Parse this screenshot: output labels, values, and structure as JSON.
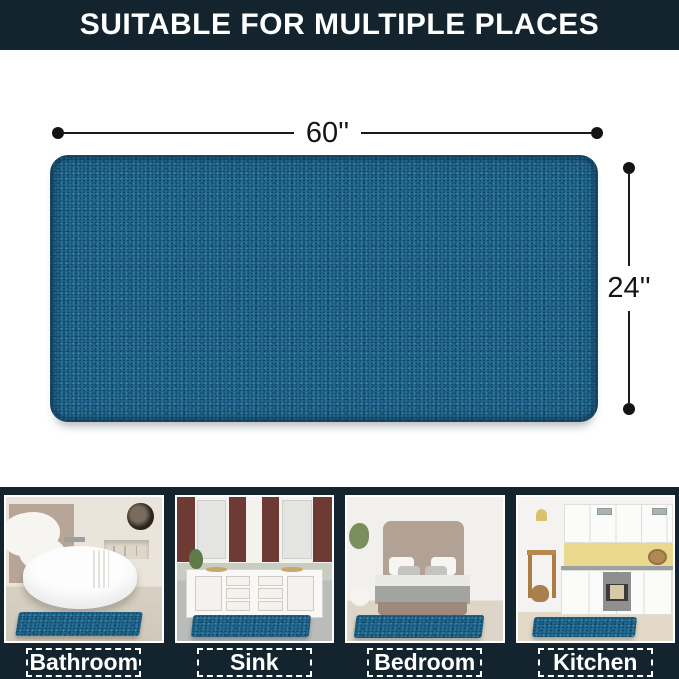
{
  "banner": {
    "text": "SUITABLE FOR MULTIPLE PLACES",
    "bg_color": "#14242e",
    "text_color": "#ffffff"
  },
  "dimensions": {
    "width": "60''",
    "height": "24''"
  },
  "rug": {
    "color": "#226a92",
    "style": "teal chenille noodle texture, rounded corners"
  },
  "gallery": [
    {
      "label": "Bathroom",
      "photo": "bathroom-with-freestanding-tub-and-rug"
    },
    {
      "label": "Sink",
      "photo": "double-vanity-sink-with-rug"
    },
    {
      "label": "Bedroom",
      "photo": "bed-with-rug-at-foot"
    },
    {
      "label": "Kitchen",
      "photo": "white-kitchen-with-rug"
    }
  ],
  "colors": {
    "navy_background": "#14242e",
    "dimension_line": "#1a1a1a",
    "label_border": "#ffffff"
  }
}
